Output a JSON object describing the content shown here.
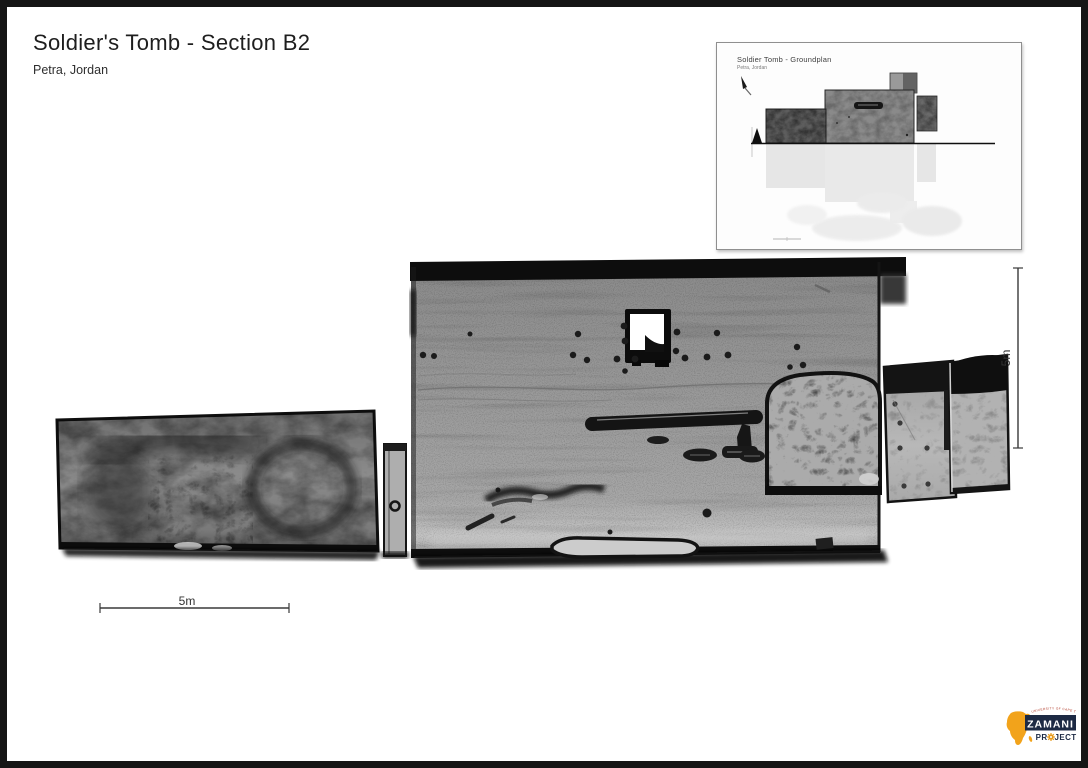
{
  "header": {
    "title": "Soldier's Tomb - Section B2",
    "subtitle": "Petra, Jordan"
  },
  "inset": {
    "title": "Soldier Tomb - Groundplan",
    "subtitle": "Petra, Jordan"
  },
  "scale_bars": {
    "horizontal": {
      "label": "5m"
    },
    "vertical": {
      "label": "5m"
    }
  },
  "logo": {
    "university": "UNIVERSITY OF CAPE TOWN",
    "name": "ZAMANI",
    "project_prefix": "PR",
    "project_suffix": "JECT",
    "colors": {
      "africa_orange": "#F2A31B",
      "navy": "#1D2A44",
      "red": "#B23B2A"
    }
  },
  "drawing": {
    "palette": {
      "wall_gray": "#999999",
      "rough_rock_gray": "#7A7A7A",
      "light_block_gray": "#B5B5B5",
      "outline_black": "#121212",
      "page_frame_black": "#151515"
    }
  }
}
